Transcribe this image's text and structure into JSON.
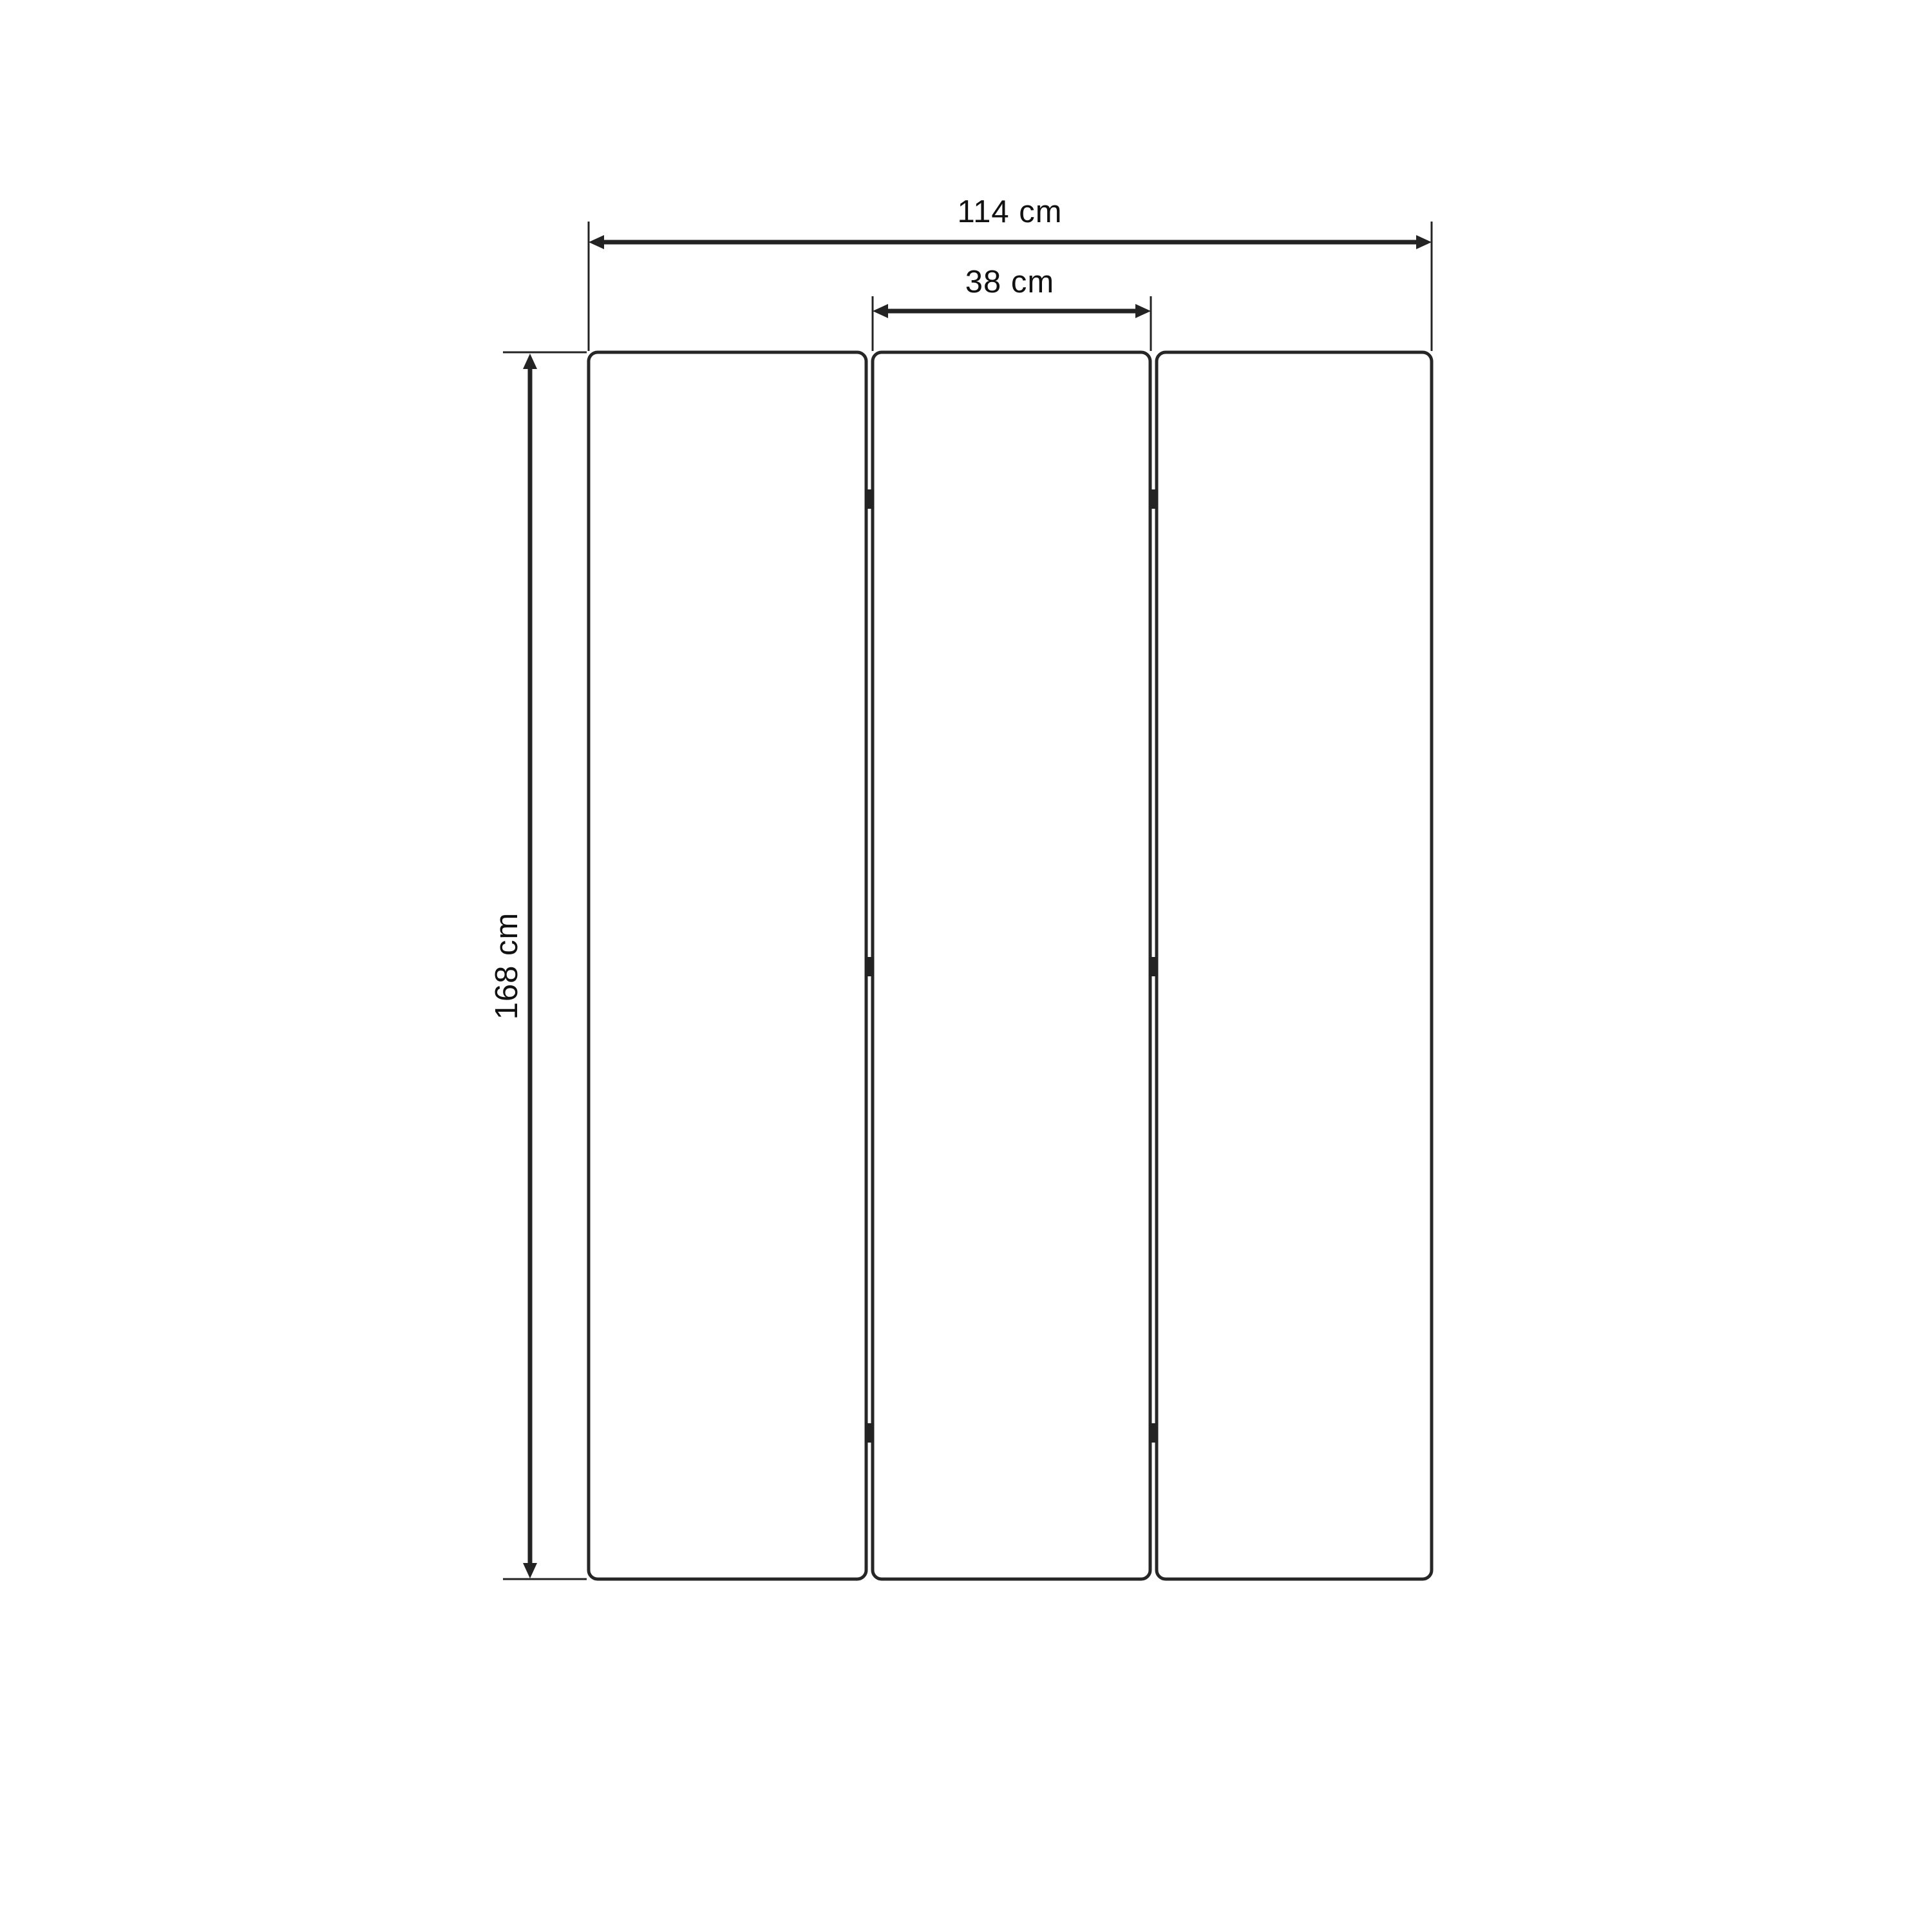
{
  "dimensions": {
    "total_width": {
      "label": "114 cm",
      "value": 114,
      "unit": "cm"
    },
    "panel_width": {
      "label": "38 cm",
      "value": 38,
      "unit": "cm"
    },
    "height": {
      "label": "168 cm",
      "value": 168,
      "unit": "cm"
    }
  },
  "panels": {
    "count": 3,
    "gaps": 2,
    "hinge_marks_per_gap": 3
  },
  "colors": {
    "background": "#ffffff",
    "line": "#232323",
    "panel_stroke": "#262626",
    "panel_fill": "#ffffff",
    "hinge": "#232323",
    "text": "#111111"
  }
}
